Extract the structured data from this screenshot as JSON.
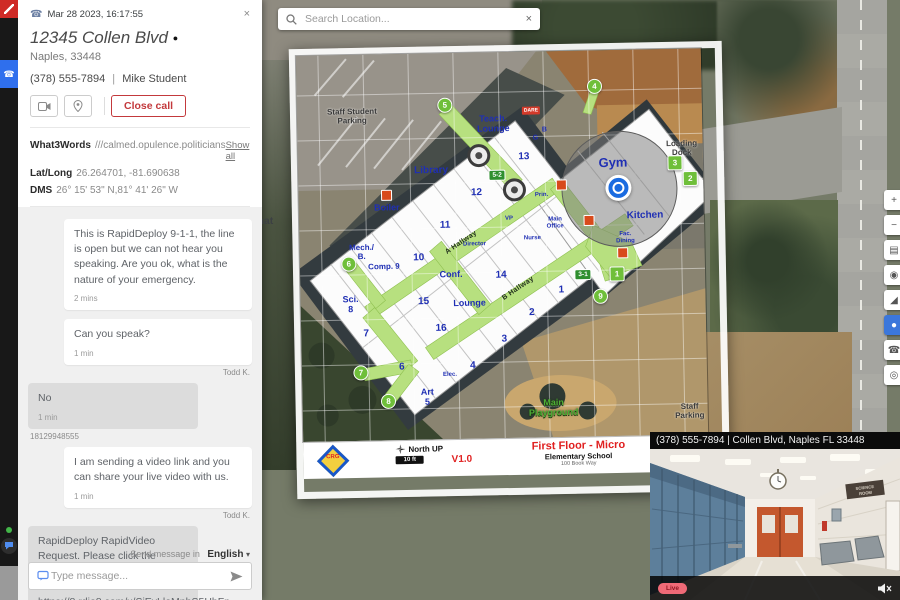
{
  "call_panel": {
    "timestamp": "Mar 28 2023, 16:17:55",
    "close_x": "×",
    "address_line1": "12345 Collen Blvd",
    "address_line2": "Naples, 33448",
    "phone": "(378) 555-7894",
    "caller_name": "Mike Student",
    "close_call_label": "Close call",
    "info": {
      "what3words_label": "What3Words",
      "what3words_value": "///calmed.opulence.politicians",
      "show_all": "Show all",
      "latlong_label": "Lat/Long",
      "latlong_value": "26.264701, -81.690638",
      "dms_label": "DMS",
      "dms_value": "26° 15' 53\" N,81° 41' 26\" W"
    },
    "tabs": [
      {
        "label": "Location timeline"
      },
      {
        "label": "Additional data"
      },
      {
        "label": "SMS chat"
      }
    ]
  },
  "chat": {
    "messages": [
      {
        "text": "This is RapidDeploy 9-1-1, the line is open but we can not hear you speaking. Are you ok, what is the nature of your emergency.",
        "time": "2 mins"
      },
      {
        "text": "Can you speak?",
        "time": "1 min",
        "sender": "Todd K."
      },
      {
        "text": "No",
        "time": "1 min",
        "sender": "18129948555"
      },
      {
        "text": "I am sending a video link and you can share your live video with us.",
        "time": "1 min",
        "sender": "Todd K."
      },
      {
        "text": "RapidDeploy RapidVideo Request. Please click the following link to share your camera's video. https://8.rdio8.com/x/SjEyLloMpbS5HbFn"
      }
    ],
    "send_in_label": "Send message in",
    "language": "English",
    "caret": "▾",
    "input_placeholder": "Type message..."
  },
  "map": {
    "search_placeholder": "Search Location...",
    "search_close": "×"
  },
  "map_controls": [
    {
      "icon": "+",
      "y": 190
    },
    {
      "icon": "−",
      "y": 215
    },
    {
      "icon": "▤",
      "y": 240
    },
    {
      "icon": "◉",
      "y": 265
    },
    {
      "icon": "◢",
      "y": 290
    },
    {
      "icon": "●",
      "y": 315,
      "kind": "active"
    },
    {
      "icon": "☎",
      "y": 340
    },
    {
      "icon": "◎",
      "y": 365
    }
  ],
  "floorplan": {
    "title": "First Floor - Micro",
    "subtitle": "Elementary School",
    "address_line": "100 Book Way",
    "version": "V1.0",
    "north_label": "North UP",
    "scale_label": "10 ft",
    "logo_text": "CRG",
    "labels": [
      {
        "t": "Staff Student Parking",
        "x": 55,
        "y": 62,
        "fs": 8,
        "cls": "gray",
        "w": 74
      },
      {
        "t": "Teach. Lounge",
        "x": 196,
        "y": 72,
        "fs": 9,
        "w": 52
      },
      {
        "t": "Library",
        "x": 133,
        "y": 117,
        "fs": 10
      },
      {
        "t": "13",
        "x": 226,
        "y": 105,
        "fs": 10
      },
      {
        "t": "12",
        "x": 178,
        "y": 140,
        "fs": 10
      },
      {
        "t": "Boiler",
        "x": 88,
        "y": 154,
        "fs": 9
      },
      {
        "t": "Mech./ B.",
        "x": 62,
        "y": 198,
        "fs": 8,
        "w": 32
      },
      {
        "t": "11",
        "x": 146,
        "y": 172,
        "fs": 10
      },
      {
        "t": "10",
        "x": 119,
        "y": 204,
        "fs": 10
      },
      {
        "t": "Comp. 9",
        "x": 84,
        "y": 213,
        "fs": 8,
        "w": 34
      },
      {
        "t": "Conf.",
        "x": 151,
        "y": 222,
        "fs": 9
      },
      {
        "t": "14",
        "x": 201,
        "y": 223,
        "fs": 10
      },
      {
        "t": "Sci. 8",
        "x": 50,
        "y": 250,
        "fs": 9,
        "w": 22
      },
      {
        "t": "15",
        "x": 123,
        "y": 248,
        "fs": 10
      },
      {
        "t": "Lounge",
        "x": 169,
        "y": 251,
        "fs": 9
      },
      {
        "t": "1",
        "x": 261,
        "y": 239,
        "fs": 10
      },
      {
        "t": "2",
        "x": 231,
        "y": 261,
        "fs": 10
      },
      {
        "t": "16",
        "x": 140,
        "y": 275,
        "fs": 10
      },
      {
        "t": "7",
        "x": 65,
        "y": 279,
        "fs": 10
      },
      {
        "t": "3",
        "x": 203,
        "y": 287,
        "fs": 10
      },
      {
        "t": "6",
        "x": 100,
        "y": 313,
        "fs": 10
      },
      {
        "t": "4",
        "x": 171,
        "y": 313,
        "fs": 10
      },
      {
        "t": "Elec.",
        "x": 148,
        "y": 322,
        "fs": 6
      },
      {
        "t": "Art 5",
        "x": 125,
        "y": 344,
        "fs": 9,
        "w": 20
      },
      {
        "t": "Gym",
        "x": 315,
        "y": 113,
        "fs": 13
      },
      {
        "t": "Kitchen",
        "x": 346,
        "y": 166,
        "fs": 10
      },
      {
        "t": "Fac. Dining",
        "x": 326,
        "y": 188,
        "fs": 6,
        "w": 26
      },
      {
        "t": "Main Office",
        "x": 256,
        "y": 172,
        "fs": 6,
        "w": 26
      },
      {
        "t": "VP",
        "x": 210,
        "y": 167,
        "fs": 6
      },
      {
        "t": "Prin.",
        "x": 243,
        "y": 144,
        "fs": 6
      },
      {
        "t": "Nurse",
        "x": 233,
        "y": 187,
        "fs": 6
      },
      {
        "t": "Director",
        "x": 175,
        "y": 192,
        "fs": 6
      },
      {
        "t": "G",
        "x": 238,
        "y": 87,
        "fs": 7
      },
      {
        "t": "B",
        "x": 247,
        "y": 79,
        "fs": 7
      },
      {
        "t": "Loading Dock",
        "x": 384,
        "y": 100,
        "fs": 8,
        "cls": "gray",
        "w": 42
      },
      {
        "t": "Staff Parking",
        "x": 387,
        "y": 363,
        "fs": 8,
        "cls": "gray",
        "w": 40
      },
      {
        "t": "Main Playground",
        "x": 251,
        "y": 357,
        "fs": 9,
        "cls": "green-label",
        "w": 62
      },
      {
        "t": "A Hallway",
        "x": 162,
        "y": 190,
        "fs": 7,
        "rot": -33,
        "cls": "hall"
      },
      {
        "t": "B Hallway",
        "x": 218,
        "y": 237,
        "fs": 7,
        "rot": -33,
        "cls": "hall"
      }
    ],
    "markers": [
      {
        "t": "5",
        "x": 148,
        "y": 52,
        "kind": "circle"
      },
      {
        "t": "4",
        "x": 298,
        "y": 36,
        "kind": "circle"
      },
      {
        "t": "3",
        "x": 377,
        "y": 114,
        "kind": "square"
      },
      {
        "t": "2",
        "x": 392,
        "y": 130,
        "kind": "square"
      },
      {
        "t": "6",
        "x": 49,
        "y": 209,
        "kind": "circle"
      },
      {
        "t": "7",
        "x": 59,
        "y": 318,
        "kind": "circle"
      },
      {
        "t": "8",
        "x": 86,
        "y": 347,
        "kind": "circle"
      },
      {
        "t": "9",
        "x": 300,
        "y": 246,
        "kind": "circle"
      },
      {
        "t": "1",
        "x": 317,
        "y": 224,
        "kind": "square"
      },
      {
        "t": "5-2",
        "x": 199,
        "y": 123,
        "kind": "tag"
      },
      {
        "t": "3-1",
        "x": 283,
        "y": 224,
        "kind": "tag"
      },
      {
        "t": "DARE",
        "x": 234,
        "y": 59,
        "kind": "dare"
      },
      {
        "t": "",
        "x": 88,
        "y": 141,
        "kind": "red"
      },
      {
        "t": "",
        "x": 263,
        "y": 134,
        "kind": "red"
      },
      {
        "t": "",
        "x": 290,
        "y": 170,
        "kind": "red"
      },
      {
        "t": "",
        "x": 323,
        "y": 203,
        "kind": "red"
      },
      {
        "t": "",
        "x": 181,
        "y": 103,
        "kind": "poi"
      },
      {
        "t": "",
        "x": 216,
        "y": 138,
        "kind": "poi"
      }
    ]
  },
  "video": {
    "caption": "(378) 555-7894 | Collen Blvd, Naples FL 33448",
    "live_label": "Live",
    "sign_text": "SCIENCE ROOM"
  }
}
